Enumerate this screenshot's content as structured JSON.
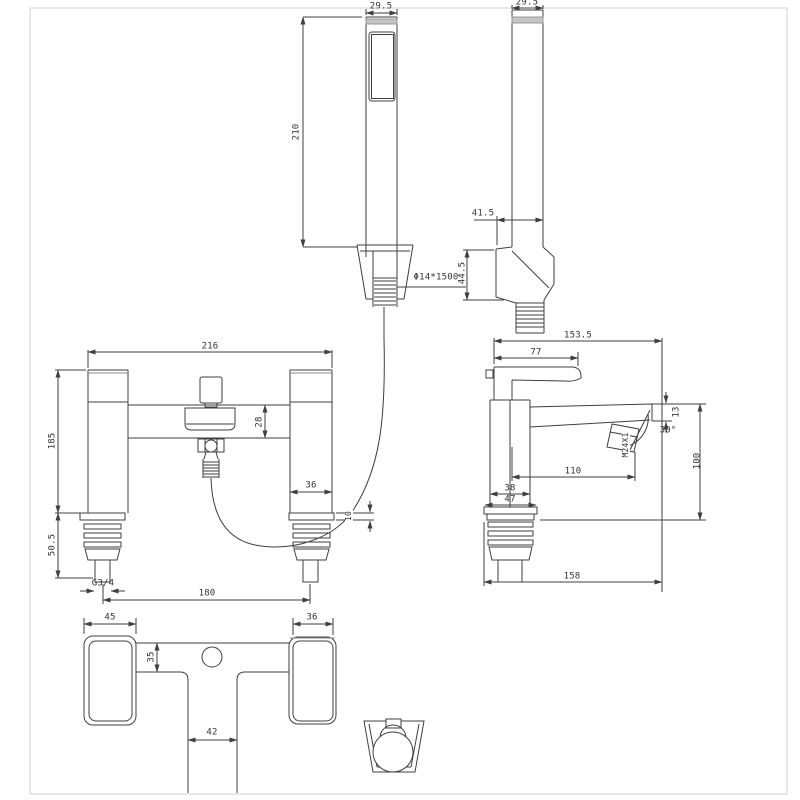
{
  "meta": {
    "type": "technical-drawing",
    "subject": "bath shower mixer tap with shower handset - dimensioned CAD views"
  },
  "colors": {
    "line": "#3f3f3f",
    "dim_text": "#343434",
    "accent_gray": "#c4c4c4",
    "border": "#cfcfcf",
    "background": "#ffffff"
  },
  "views": {
    "handset_front": {
      "width": "29.5",
      "height": "210",
      "hose": "Φ14*1500"
    },
    "handset_side": {
      "width": "29.5",
      "head_depth": "41.5",
      "head_height": "44.5"
    },
    "mixer_front": {
      "overall_width": "216",
      "body_height": "185",
      "shank_height": "50.5",
      "spout_height": "28",
      "pillar_width": "36",
      "deck_plate": "10",
      "thread": "G3/4",
      "inlet_centres": "180"
    },
    "mixer_side": {
      "overall_depth": "153.5",
      "handle_length": "77",
      "spout_tip": "13",
      "spout_angle": "30°",
      "aerator_thread": "M24X1",
      "spout_reach": "110",
      "spout_clearance": "100",
      "body_depth": "38",
      "flange_depth": "47",
      "base_depth": "158"
    },
    "mixer_plan": {
      "handle_width": "45",
      "handle_depth": "36",
      "bar_depth": "35",
      "spout_width": "42"
    }
  }
}
